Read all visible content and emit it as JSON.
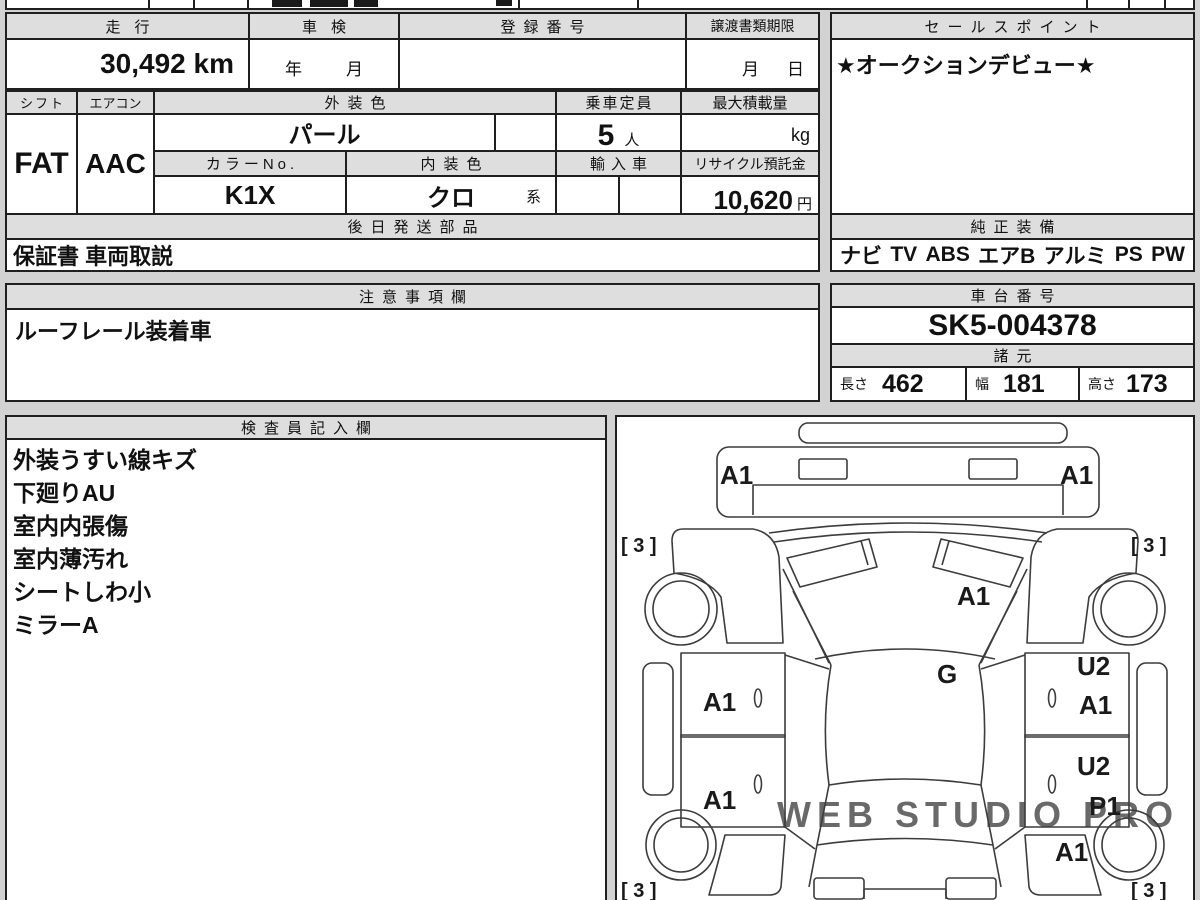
{
  "colors": {
    "background": "#d2d2d2",
    "border": "#1f1f1f",
    "header_bg": "#dedede",
    "text": "#111111",
    "watermark": "#dfd3d3"
  },
  "top_table": {
    "mileage_label": "走行",
    "mileage_value": "30,492 km",
    "inspection_label": "車検",
    "inspection_year": "年",
    "inspection_month": "月",
    "registration_label": "登録番号",
    "registration_value": "",
    "transfer_label": "譲渡書類期限",
    "transfer_month": "月",
    "transfer_day": "日"
  },
  "sales_point": {
    "label": "セールスポイント",
    "value": "★オークションデビュー★"
  },
  "spec_table": {
    "shift_label": "シフト",
    "shift_value": "FAT",
    "aircon_label": "エアコン",
    "aircon_value": "AAC",
    "exterior_color_label": "外装色",
    "exterior_color_value": "パール",
    "capacity_label": "乗車定員",
    "capacity_value": "5",
    "capacity_unit": "人",
    "max_load_label": "最大積載量",
    "max_load_unit": "kg",
    "color_no_label": "カラーNo.",
    "color_no_value": "K1X",
    "interior_color_label": "内装色",
    "interior_color_value": "クロ",
    "interior_color_suffix": "系",
    "import_label": "輸入車",
    "recycle_label": "リサイクル預託金",
    "recycle_value": "10,620",
    "recycle_unit": "円"
  },
  "later_parts": {
    "label": "後日発送部品",
    "value": "保証書 車両取説"
  },
  "genuine_equipment": {
    "label": "純正装備",
    "items": [
      "ナビ",
      "TV",
      "ABS",
      "エアB",
      "アルミ",
      "PS",
      "PW"
    ]
  },
  "notes": {
    "label": "注意事項欄",
    "value": "ルーフレール装着車"
  },
  "chassis": {
    "label": "車台番号",
    "value": "SK5-004378"
  },
  "dimensions": {
    "label": "諸元",
    "length_label": "長さ",
    "length_value": "462",
    "width_label": "幅",
    "width_value": "181",
    "height_label": "高さ",
    "height_value": "173"
  },
  "inspector_notes": {
    "label": "検査員記入欄",
    "lines": [
      "外装うすい線キズ",
      "下廻りAU",
      "室内内張傷",
      "室内薄汚れ",
      "シートしわ小",
      "ミラーA"
    ]
  },
  "diagram": {
    "labels": {
      "front_bumper_left": "A1",
      "front_bumper_right": "A1",
      "tire_front_left": "[ 3 ]",
      "tire_front_right": "[ 3 ]",
      "hood": "A1",
      "cowl": "G",
      "front_left_door": "A1",
      "rear_left_door": "A1",
      "front_right_door_upper": "U2",
      "front_right_door": "A1",
      "rear_right_door_upper": "U2",
      "rear_right_door": "P1",
      "rear_right_quarter": "A1",
      "tire_rear_left": "[ 3 ]",
      "tire_rear_right": "[ 3 ]"
    },
    "watermark": "WEB STUDIO PRO"
  }
}
